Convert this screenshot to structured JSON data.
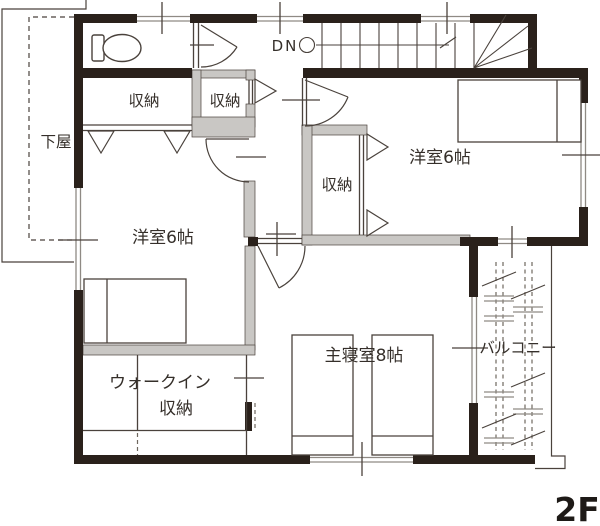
{
  "floor_label": "2F",
  "stairs": {
    "down_label": "DN"
  },
  "rooms": {
    "geya": {
      "label": "下屋"
    },
    "closet_top_left": {
      "label": "収納"
    },
    "closet_top_middle": {
      "label": "収納"
    },
    "closet_center": {
      "label": "収納"
    },
    "western_left": {
      "label": "洋室6帖"
    },
    "western_right": {
      "label": "洋室6帖"
    },
    "master": {
      "label": "主寝室8帖"
    },
    "walkin_line1": {
      "label": "ウォークイン"
    },
    "walkin_line2": {
      "label": "収納"
    },
    "balcony": {
      "label": "バルコニー"
    }
  },
  "colors": {
    "wall": "#2a211b",
    "interior_wall": "#c9c7c4",
    "line": "#4a423c",
    "window_line": "#8f8a84",
    "dashed_line": "#6f675f",
    "text": "#352f2a"
  }
}
